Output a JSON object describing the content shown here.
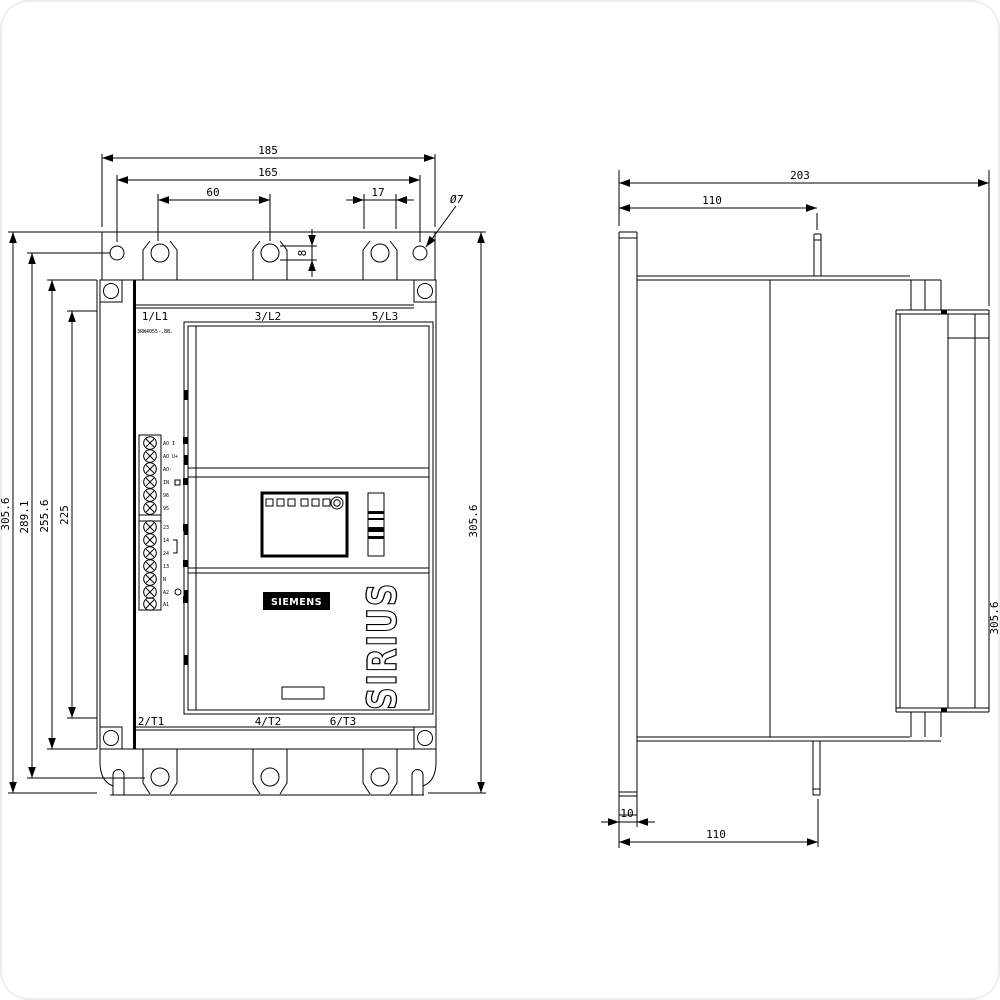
{
  "front_view": {
    "line_terminals_top": [
      "1/L1",
      "3/L2",
      "5/L3"
    ],
    "line_terminals_bottom": [
      "2/T1",
      "4/T2",
      "6/T3"
    ],
    "type_label": "3RW4055-.BB.",
    "brand_label": "SIEMENS",
    "product_label": "SIRIUS",
    "control_terminals_upper": [
      "AO I",
      "AO U+",
      "AO-",
      "IN",
      "96",
      "95"
    ],
    "control_terminals_lower": [
      "23",
      "14",
      "24",
      "13",
      "N",
      "A2",
      "A1"
    ]
  },
  "dimensions": {
    "front": {
      "overall_width": "185",
      "fixing_hole_span": "165",
      "fixing_hole_pitch": "60",
      "slot_width": "17",
      "slot_height": "8",
      "fixing_hole_diameter": "Ø7",
      "overall_height": "305.6",
      "fixing_height": "289.1",
      "housing_height": "255.6",
      "panel_height": "225",
      "overall_height_right": "305.6"
    },
    "side": {
      "overall_depth": "203",
      "fixing_depth_top": "110",
      "rail_thickness": "10",
      "fixing_depth_bottom": "110",
      "overall_height": "305.6"
    }
  }
}
